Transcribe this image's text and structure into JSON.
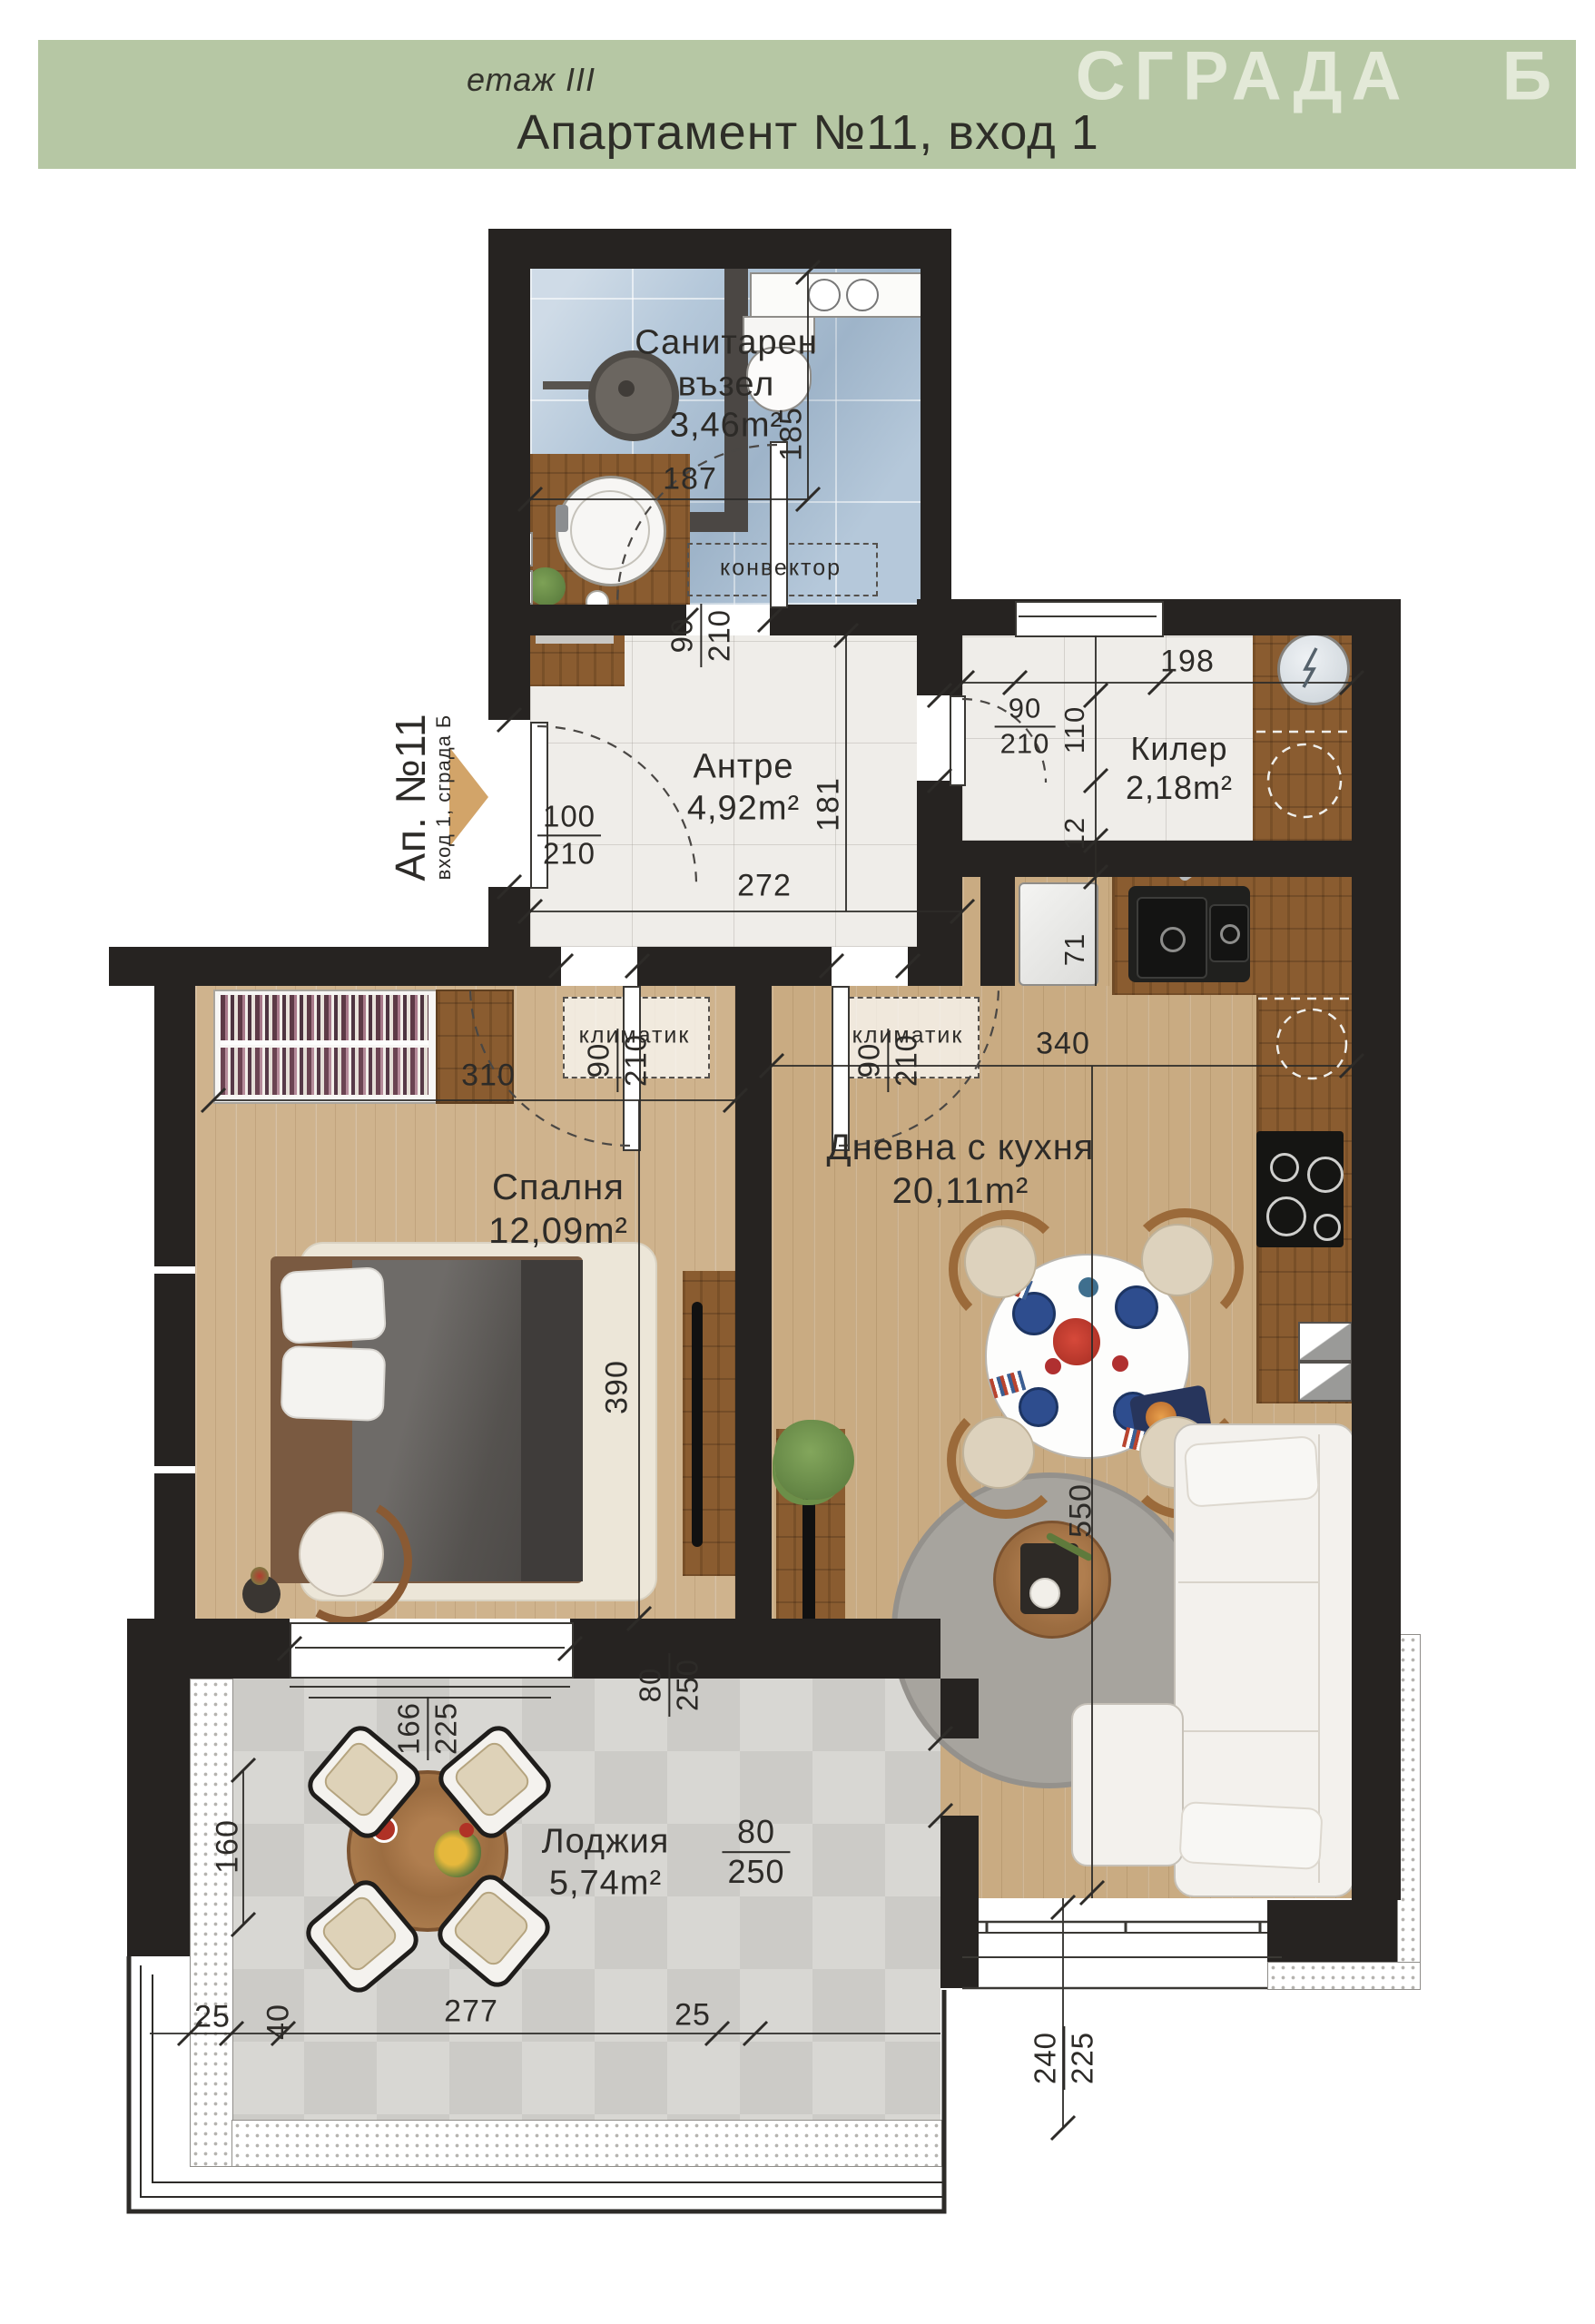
{
  "header": {
    "floor_label": "етаж III",
    "title": "Апартамент №11, вход 1",
    "building": "СГРАДА Б"
  },
  "entrance": {
    "apartment": "Ап. №11",
    "entry": "вход 1, сграда Б"
  },
  "rooms": {
    "bathroom": {
      "name1": "Санитарен",
      "name2": "възел",
      "area": "3,46m²"
    },
    "antre": {
      "name": "Антре",
      "area": "4,92m²"
    },
    "kiler": {
      "name": "Килер",
      "area": "2,18m²"
    },
    "bedroom": {
      "name": "Спалня",
      "area": "12,09m²"
    },
    "living": {
      "name": "Дневна с кухня",
      "area": "20,11m²"
    },
    "loggia": {
      "name": "Лоджия",
      "area": "5,74m²"
    }
  },
  "annotations": {
    "convector": "конвектор",
    "klimatik": "климатик"
  },
  "dims": {
    "bath_w": "187",
    "bath_h": "185",
    "door_w": "90",
    "door_h": "210",
    "entry_w": "100",
    "entry_h": "210",
    "antre_w": "272",
    "antre_len": "181",
    "kiler_w": "198",
    "kiler_niche": "110",
    "wall_a": "71",
    "wall_b": "12",
    "bedroom_w": "310",
    "bedroom_len": "390",
    "living_w": "340",
    "living_len": "550",
    "bed_window_w": "166",
    "bed_window_h": "225",
    "balc_door_w": "80",
    "balc_door_h": "250",
    "loggia_len": "160",
    "loggia_d1": "25",
    "loggia_d2": "40",
    "loggia_w": "277",
    "loggia_d3": "25",
    "liv_window_w": "240",
    "liv_window_h": "225"
  },
  "colors": {
    "header_band": "#b6c7a4",
    "header_building_text": "#e3e9d8",
    "wall": "#262321",
    "accent_arrow": "#d2a469"
  }
}
